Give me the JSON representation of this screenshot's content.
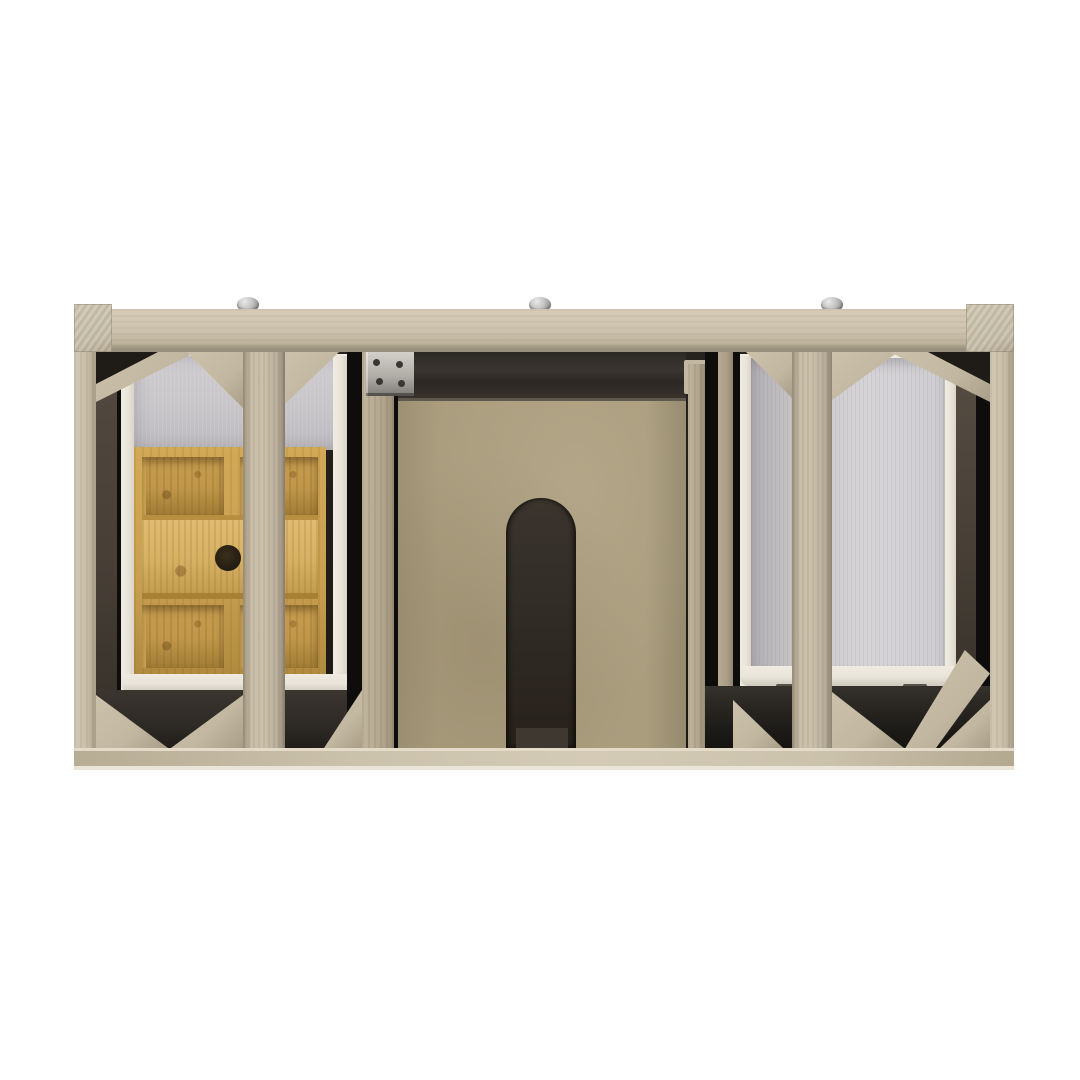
{
  "scene": {
    "description": "Top-down product photograph of an unfinished light-oak bathroom vanity cabinet frame on a white background, showing two open drawer boxes - the left one fitted with a bamboo drawer organizer that has a sliding lid with a round finger hole - a central plywood plumbing panel with an arched cutout, diagonal corner braces at every post and stile, and three silver mounting screws along the top rail.",
    "background": "white",
    "screw_count": 3,
    "drawer_count": 2,
    "organizer_open_compartments": 4,
    "organizer_lid_count": 1
  },
  "palette": {
    "bg": "#ffffff",
    "wood_rail": "#cdc3ae",
    "wood_rail_dark": "#9a9080",
    "wood_cap": "#c8bfab",
    "wood_post": "#c9bfa9",
    "wood_post_dark": "#a89d87",
    "wood_stile": "#b9ae9c",
    "wood_stile_light": "#c9bea8",
    "wood_brace": "#c2b7a0",
    "wood_wall": "#b2a78e",
    "wood_wall2": "#aa9f86",
    "bottom_rail": "#cbc2ac",
    "bottom_rail_edge": "#eae4d6",
    "interior_dark": "#221e1a",
    "interior_deep": "#0e0d0b",
    "interior_soft": "#2e2a25",
    "interior_brown": "#473f36",
    "panel_ply": "#aa9d7e",
    "panel_edge": "#5f584e",
    "arch_dark": "#322d27",
    "arch_step": "#3e3831",
    "bamboo_frame": "#c89f50",
    "bamboo_divider": "#d4ab58",
    "bamboo_lid": "#d6b164",
    "bamboo_cell": "#bf964a",
    "bamboo_cell_dark": "#a07c35",
    "bamboo_hole": "#231c11",
    "white_box": "#e9e4da",
    "white_box_dim": "#d9d3c7",
    "gray_left": "#c8c5c9",
    "gray_right": "#cfcdd0",
    "gray_right_dim": "#b1aeb2",
    "metal": "#b0ada7",
    "metal_dark": "#7e7b76",
    "screw_hi": "#e9e9e9",
    "screw_lo": "#7d7d7d"
  }
}
